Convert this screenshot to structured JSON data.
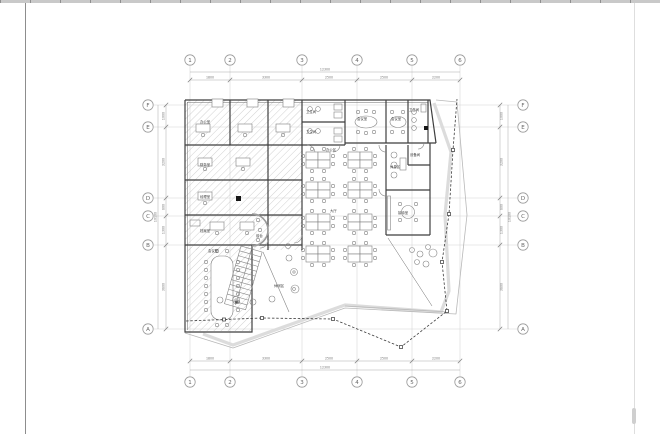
{
  "grid": {
    "columns": [
      "1",
      "2",
      "3",
      "4",
      "5",
      "6"
    ],
    "rows": [
      "F",
      "E",
      "D",
      "C",
      "B",
      "A"
    ]
  },
  "dims": {
    "top": {
      "segments": [
        "1800",
        "3300",
        "2500",
        "2500",
        "2200"
      ],
      "overall": "12300"
    },
    "bottom": {
      "segments": [
        "1800",
        "3300",
        "2500",
        "2500",
        "2200"
      ],
      "overall": "12300"
    },
    "left": {
      "segments": [
        "1000",
        "3200",
        "800",
        "1300",
        "3800"
      ],
      "overall": "10100"
    },
    "right": {
      "segments": [
        "1000",
        "3200",
        "800",
        "1300",
        "3800"
      ],
      "overall": "10100"
    }
  },
  "rooms": [
    {
      "label": "办公室"
    },
    {
      "label": "卫生间"
    },
    {
      "label": "卫生间"
    },
    {
      "label": "会议室"
    },
    {
      "label": "会议室"
    },
    {
      "label": "卫生间"
    },
    {
      "label": "设备间"
    },
    {
      "label": "办公区"
    },
    {
      "label": "财务室"
    },
    {
      "label": "经理室"
    },
    {
      "label": "档案室"
    },
    {
      "label": "休息区"
    },
    {
      "label": "接待室"
    },
    {
      "label": "会议室"
    },
    {
      "label": "前台"
    },
    {
      "label": "休闲区"
    },
    {
      "label": "大厅"
    }
  ],
  "stair": {
    "label": "上"
  }
}
